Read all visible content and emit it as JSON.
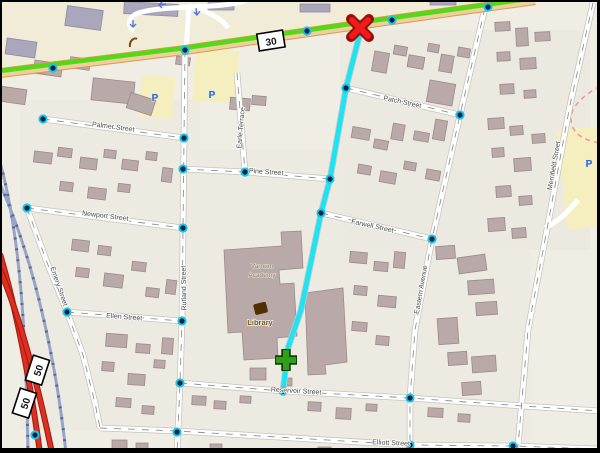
{
  "map": {
    "view": "street-map-with-route",
    "highway_shields": {
      "route_30": "30",
      "route_50": "50"
    },
    "streets": {
      "palmer": "Palmer Street",
      "patch": "Patch Street",
      "pine": "Pine Street",
      "newport": "Newport Street",
      "emery": "Emery Street",
      "ellen": "Ellen Street",
      "rutland": "Rutland Street",
      "earle_terrace": "Earle Terrace",
      "farwell": "Farwell Street",
      "eastern_avenue": "Eastern Avenue",
      "merrifield": "Merrifield Street",
      "reservoir": "Reservoir Street",
      "elliott": "Elliott Street"
    },
    "pois": {
      "library": "Library",
      "academy_line1": "Varnum",
      "academy_line2": "Academy",
      "parking_symbol": "P"
    },
    "route": {
      "line_color": "#1fe2f2",
      "start_marker": "green-plus",
      "end_marker": "red-x"
    },
    "colors": {
      "land": "#f0ede5",
      "land_commercial": "#f0ecd8",
      "building": "#b9a9a9",
      "parking_fill": "#f5efc0",
      "route30_green": "#55d915",
      "route50_red": "#dd2f20",
      "railway": "#8593b8",
      "route_cyan": "#1fe2f2"
    }
  }
}
